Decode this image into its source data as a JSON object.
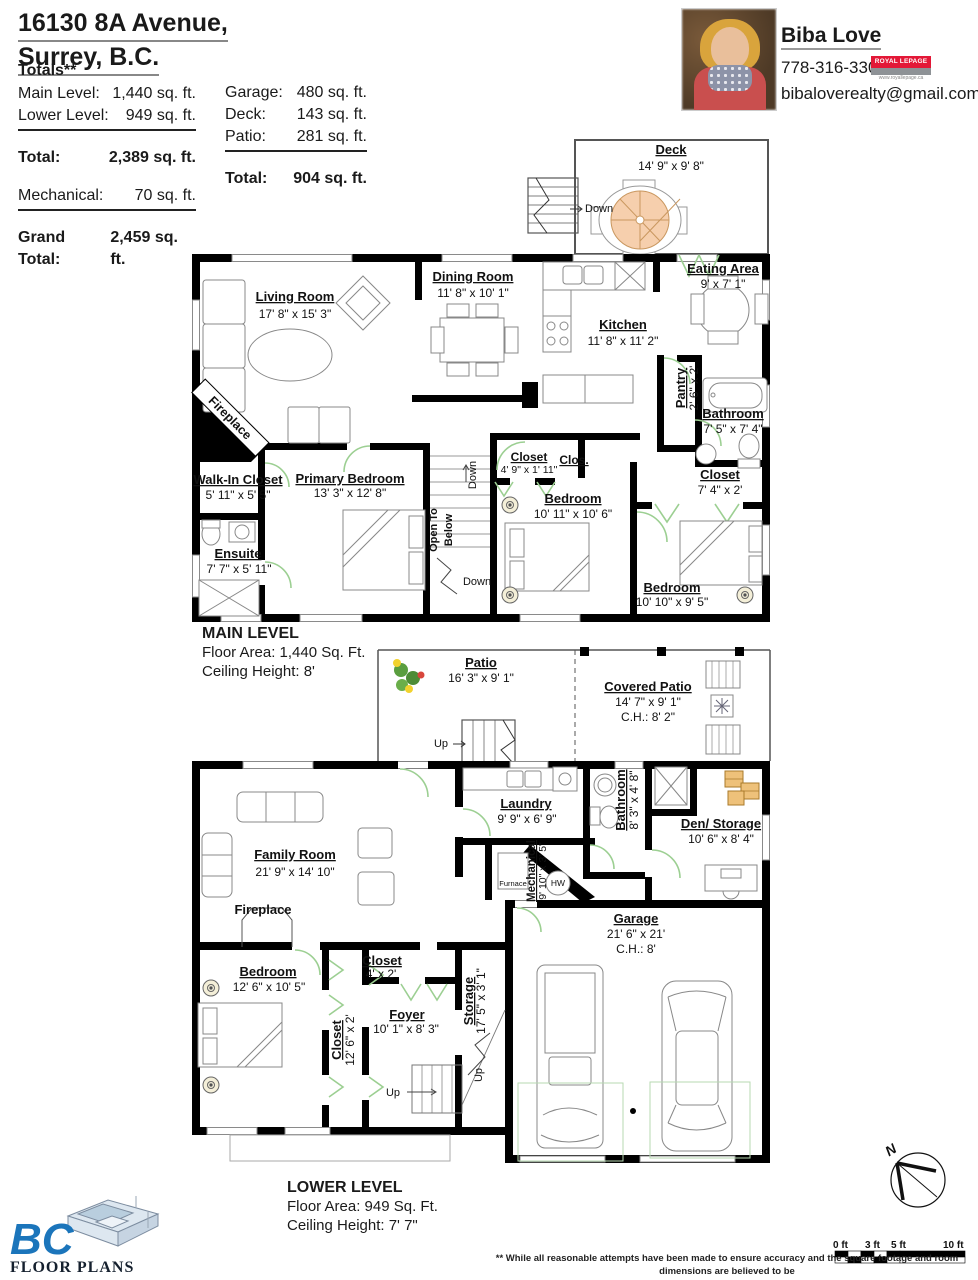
{
  "header": {
    "address_line1": "16130 8A Avenue,",
    "address_line2": "Surrey, B.C.",
    "totals_title": "Totals**",
    "left": [
      {
        "label": "Main Level:",
        "value": "1,440 sq. ft."
      },
      {
        "label": "Lower Level:",
        "value": "949 sq. ft."
      },
      {
        "label": "Total:",
        "value": "2,389 sq. ft."
      },
      {
        "label": "Mechanical:",
        "value": "70 sq. ft."
      },
      {
        "label": "Grand Total:",
        "value": "2,459 sq. ft."
      }
    ],
    "right": [
      {
        "label": "Garage:",
        "value": "480 sq. ft."
      },
      {
        "label": "Deck:",
        "value": "143 sq. ft."
      },
      {
        "label": "Patio:",
        "value": "281 sq. ft."
      },
      {
        "label": "Total:",
        "value": "904 sq. ft."
      }
    ]
  },
  "agent": {
    "name": "Biba Love",
    "phone": "778-316-3300",
    "email": "bibaloverealty@gmail.com",
    "brand": "ROYAL LEPAGE",
    "brand_site": "www.royallepage.ca"
  },
  "main_level": {
    "title": "MAIN LEVEL",
    "floor_area": "Floor Area: 1,440 Sq. Ft.",
    "ceiling": "Ceiling Height: 8'",
    "rooms": {
      "deck": {
        "name": "Deck",
        "dims": "14' 9\" x 9' 8\""
      },
      "living": {
        "name": "Living Room",
        "dims": "17' 8\" x 15' 3\""
      },
      "dining": {
        "name": "Dining Room",
        "dims": "11' 8\" x 10' 1\""
      },
      "kitchen": {
        "name": "Kitchen",
        "dims": "11' 8\" x 11' 2\""
      },
      "eating": {
        "name": "Eating Area",
        "dims": "9' x 7' 1\""
      },
      "pantry": {
        "name": "Pantry",
        "dims": "2' 6\" x 2'"
      },
      "bathroom": {
        "name": "Bathroom",
        "dims": "7' 5\" x 7' 4\""
      },
      "closet_hall": {
        "name": "Closet",
        "dims": "7' 4\" x 2'"
      },
      "closet_bedroom": {
        "name": "Closet",
        "dims": "4' 9\" x 1' 11\""
      },
      "closet_abbrev": {
        "name": "Clos."
      },
      "bedroom_middle": {
        "name": "Bedroom",
        "dims": "10' 11\" x 10' 6\""
      },
      "bedroom_right": {
        "name": "Bedroom",
        "dims": "10' 10\" x 9' 5\""
      },
      "walk_in_closet": {
        "name": "Walk-In Closet",
        "dims": "5' 11\" x 5' 5\""
      },
      "primary_bedroom": {
        "name": "Primary Bedroom",
        "dims": "13' 3\" x 12' 8\""
      },
      "ensuite": {
        "name": "Ensuite",
        "dims": "7' 7\" x 5' 11\""
      },
      "fireplace": {
        "name": "Fireplace"
      }
    },
    "stairs": {
      "open_to": "Open To",
      "below": "Below",
      "down": "Down"
    }
  },
  "outdoor": {
    "patio": {
      "name": "Patio",
      "dims": "16' 3\" x 9' 1\""
    },
    "covered_patio": {
      "name": "Covered Patio",
      "dims": "14' 7\" x 9' 1\"",
      "ceiling": "C.H.: 8' 2\""
    },
    "up": "Up"
  },
  "lower_level": {
    "title": "LOWER LEVEL",
    "floor_area": "Floor Area: 949 Sq. Ft.",
    "ceiling": "Ceiling Height: 7' 7\"",
    "rooms": {
      "family": {
        "name": "Family Room",
        "dims": "21' 9\" x 14' 10\""
      },
      "fireplace": {
        "name": "Fireplace"
      },
      "laundry": {
        "name": "Laundry",
        "dims": "9' 9\" x 6' 9\""
      },
      "bathroom": {
        "name": "Bathroom",
        "dims": "8' 3\" x 4' 8\""
      },
      "den": {
        "name": "Den/ Storage",
        "dims": "10' 6\" x 8' 4\""
      },
      "mechanical": {
        "name": "Mechanical",
        "dims": "9' 10\" x 3' 5\""
      },
      "furnace": {
        "name": "Furnace"
      },
      "hw": {
        "name": "HW"
      },
      "garage": {
        "name": "Garage",
        "dims": "21' 6\" x 21'",
        "ceiling": "C.H.: 8'"
      },
      "bedroom": {
        "name": "Bedroom",
        "dims": "12' 6\" x 10' 5\""
      },
      "closet_tall": {
        "name": "Closet",
        "dims": "12' 6\" x 2'"
      },
      "closet_small": {
        "name": "Closet",
        "dims": "4' x 2'"
      },
      "foyer": {
        "name": "Foyer",
        "dims": "10' 1\" x 8' 3\""
      },
      "storage": {
        "name": "Storage",
        "dims": "17' 5\" x 3' 1\""
      }
    },
    "up": "Up"
  },
  "footer": {
    "logo_text": "BC",
    "logo_subtext": "FLOOR PLANS",
    "compass_n": "N",
    "scale_labels": [
      "0 ft",
      "3 ft",
      "5 ft",
      "10 ft"
    ],
    "disclaimer_line1": "** While all reasonable attempts have been made to ensure accuracy and the square footage and room dimensions are believed to be",
    "disclaimer_line2": "correct to ANSI Standards, due to the possibility of human error the information cannot be guaranteed. E&O Insured for $1,000,000"
  }
}
